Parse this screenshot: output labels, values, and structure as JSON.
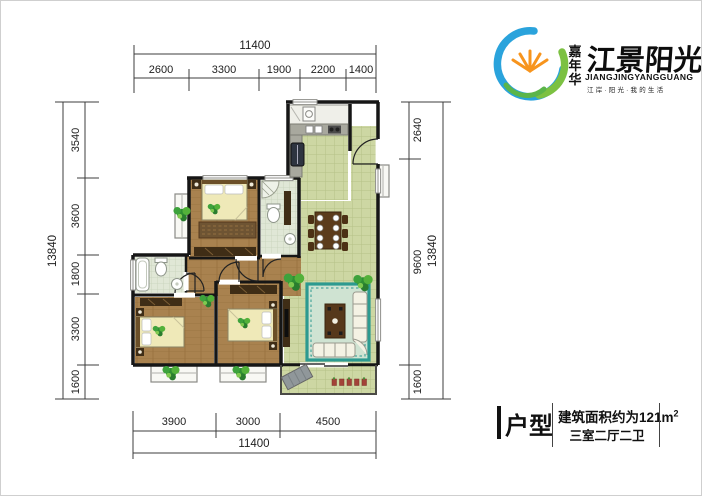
{
  "logo": {
    "brand": "嘉年华",
    "name": "江景阳光",
    "pinyin": "JIANGJINGYANGGUANG",
    "tagline": "江岸·阳光·我的生活"
  },
  "unit_info": {
    "label": "户型",
    "area": "建筑面积约为121m",
    "area_sup": "2",
    "rooms": "三室二厅二卫"
  },
  "dims": {
    "top": {
      "total": "11400",
      "segments": [
        "2600",
        "3300",
        "1900",
        "2200",
        "1400"
      ]
    },
    "bottom": {
      "total": "11400",
      "segments": [
        "3900",
        "3000",
        "4500"
      ]
    },
    "left": {
      "total": "13840",
      "segments": [
        "3540",
        "3600",
        "1800",
        "3300",
        "1600"
      ]
    },
    "right": {
      "total": "13840",
      "segments": [
        "2640",
        "9600",
        "1600"
      ]
    }
  },
  "colors": {
    "tile_floor": "#cdd7a3",
    "wood_floor": "#a9824f",
    "bath_floor": "#e0e7d6",
    "rug_teal": "#2d9a90",
    "wall": "#161616",
    "logo_blue": "#2aa3dc",
    "logo_green": "#7cc142",
    "logo_orange": "#f7941d"
  }
}
